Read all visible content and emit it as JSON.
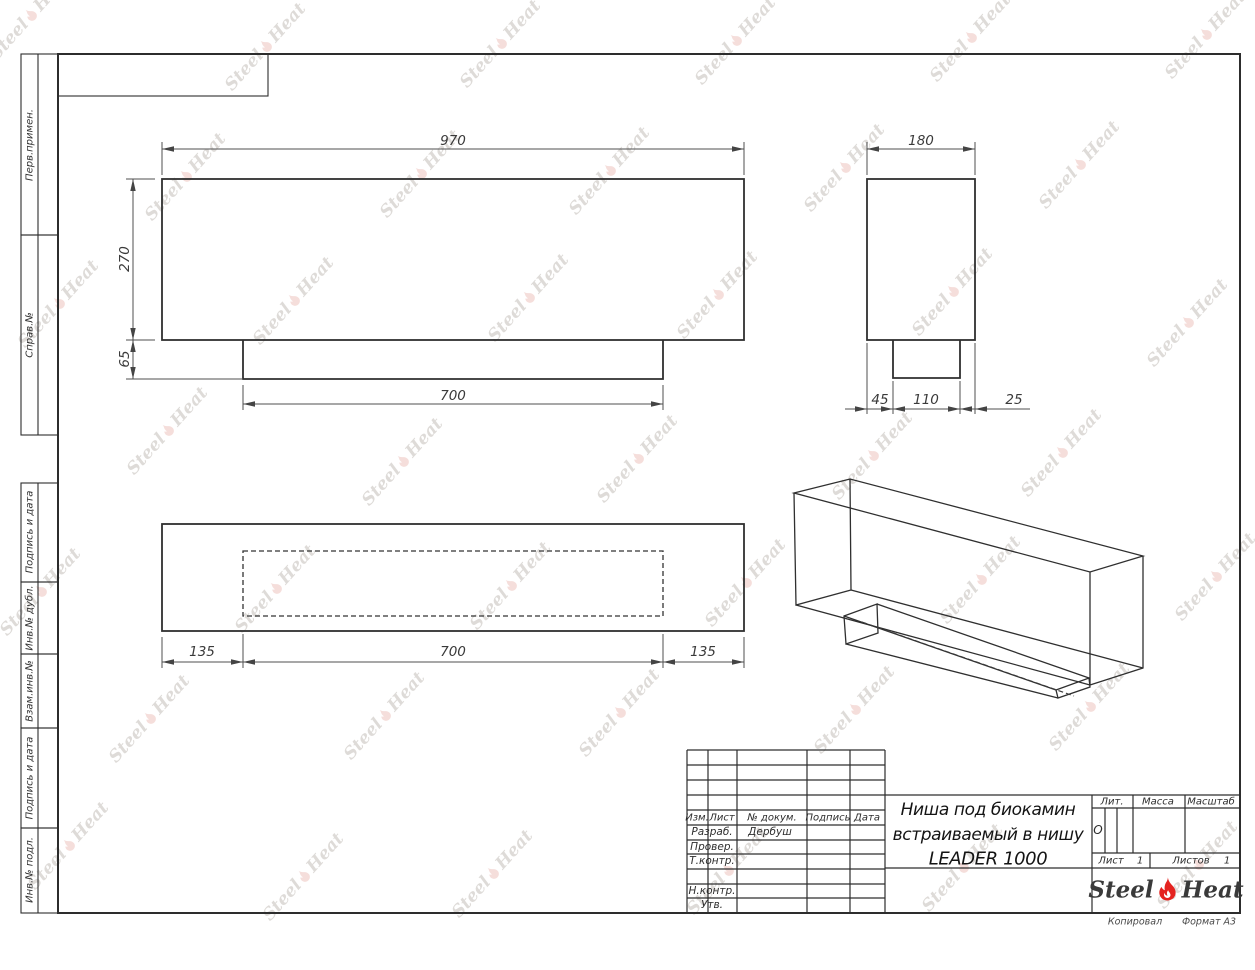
{
  "watermark": {
    "part1": "Steel",
    "part2": "Heat"
  },
  "side_strip": {
    "sections": [
      {
        "label": "Перв.примен."
      },
      {
        "label": "Справ.№"
      },
      {
        "label": "Подпись и дата"
      },
      {
        "label": "Инв.№ дубл."
      },
      {
        "label": "Взам.инв.№"
      },
      {
        "label": "Подпись и дата"
      },
      {
        "label": "Инв.№ подл."
      }
    ]
  },
  "views": {
    "front": {
      "dim_width": "970",
      "dim_height": "270",
      "dim_tab_height": "65",
      "dim_tab_width": "700"
    },
    "side": {
      "dim_width": "180",
      "dim_left": "45",
      "dim_middle": "110",
      "dim_right": "25"
    },
    "plan": {
      "dim_left": "135",
      "dim_center": "700",
      "dim_right": "135"
    }
  },
  "title_block": {
    "header_cols": [
      "Изм.",
      "Лист",
      "№ докум.",
      "Подпись",
      "Дата"
    ],
    "rows": [
      {
        "label": "Разраб.",
        "value": "Дербуш"
      },
      {
        "label": "Провер.",
        "value": ""
      },
      {
        "label": "Т.контр.",
        "value": ""
      },
      {
        "label": "",
        "value": ""
      },
      {
        "label": "Н.контр.",
        "value": ""
      },
      {
        "label": "Утв.",
        "value": ""
      }
    ],
    "title_lines": [
      "Ниша под биокамин",
      "встраиваемый в нишу",
      "LEADER 1000"
    ],
    "lit_label": "Лит.",
    "lit_value": "О",
    "mass_label": "Масса",
    "scale_label": "Масштаб",
    "sheet_label": "Лист",
    "sheet_value": "1",
    "sheets_label": "Листов",
    "sheets_value": "1",
    "logo": {
      "part1": "Steel",
      "part2": "Heat"
    }
  },
  "footer": {
    "copied_label": "Копировал",
    "format_label": "Формат А3"
  }
}
